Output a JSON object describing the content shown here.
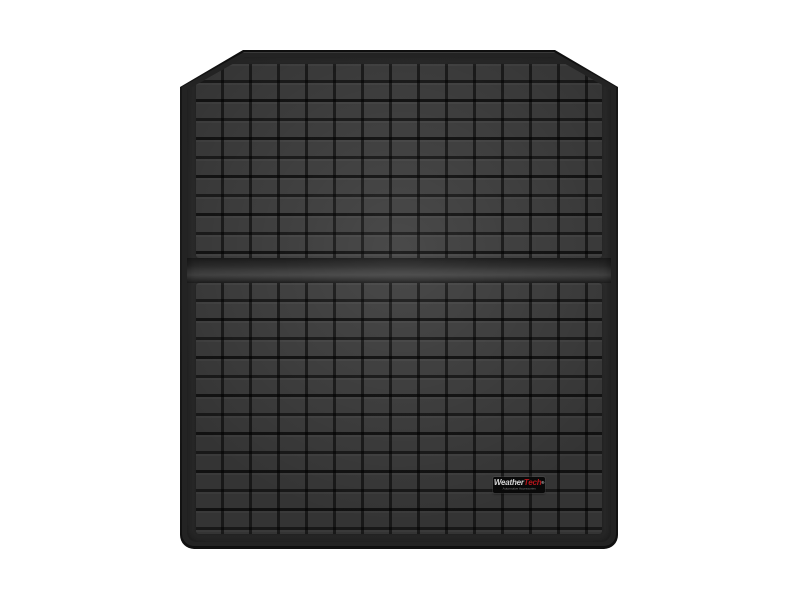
{
  "page": {
    "background_color": "#ffffff",
    "description": "Product photo of a black molded vehicle cargo liner floor mat with embossed square grid tread, chamfered top corners, a smooth transverse fold ridge, and a WeatherTech logo plate near the bottom"
  },
  "colors": {
    "page-bg": "#ffffff",
    "mat-edge": "#161616",
    "mat-face": "#404040",
    "groove": "#1f1f1f",
    "channel": "#333333",
    "badge-bg": "#0b0b0b",
    "brand-white": "#ffffff",
    "brand-red": "#e01b22",
    "tagline-gray": "#9a9a9a"
  },
  "badge": {
    "brand_white": "Weather",
    "brand_red": "Tech",
    "registered": "®",
    "tagline": "Automotive Accessories"
  }
}
